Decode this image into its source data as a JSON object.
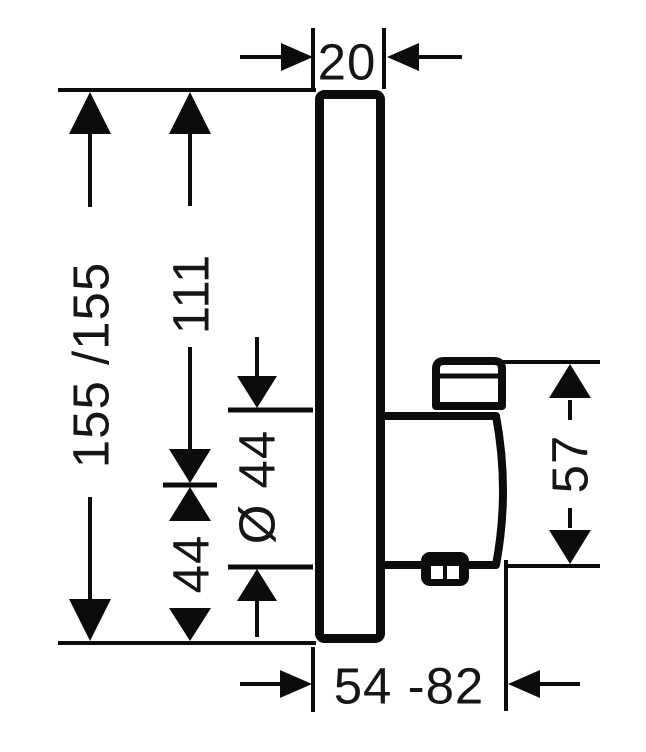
{
  "drawing": {
    "colors": {
      "ink": "#0c0c0c",
      "background": "#ffffff"
    },
    "dimensions": {
      "plate_depth": "20",
      "plate_height": "155 /155",
      "top_to_handle_axis": "111",
      "handle_axis_to_bottom": "44",
      "handle_diameter": "Ø 44",
      "handle_height": "57",
      "installation_depth_range": "54 -82"
    }
  }
}
